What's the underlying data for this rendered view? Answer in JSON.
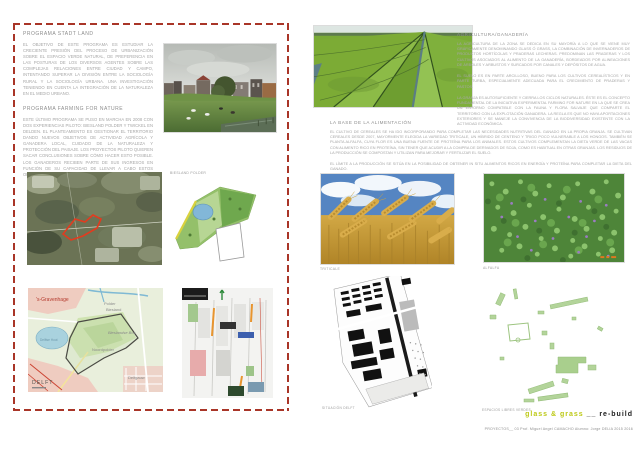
{
  "board": {
    "left": {
      "sections": [
        {
          "heading": "PROGRAMA STADT LAND",
          "body": "EL OBJETIVO DE ESTE PROGRAMA ES ESTUDIAR LA CRECIENTE PRESIÓN DEL PROCESO DE URBANIZACIÓN SOBRE EL ESPACIO VERDE NATURAL, DE PREFERENCIA EN LAS POSTURAS DE LOS DIVERSOS AGENTES SOBRE LAS COMPLEJAS RELACIONES ENTRE CIUDAD Y CAMPO, INTENTANDO SUPERAR LA DIVISIÓN ENTRE LA SOCIOLOGÍA RURAL Y LA SOCIOLOGÍA URBANA. UNA INVESTIGACIÓN TENIENDO EN CUENTA LA INTEGRACIÓN DE LA NATURALEZA EN EL MEDIO URBANO."
        },
        {
          "heading": "PROGRAMA FARMING FOR NATURE",
          "body": "ESTE ÚLTIMO PROGRAMA SE PUSO EN MARCHA EN 2008 CON DOS EXPERIENCIAS PILOTO: BIESLAND POLDER Y TWICKEL EN DELDEN. EL PLANTEAMIENTO ES GESTIONAR EL TERRITORIO DANDO NUEVOS OBJETIVOS DE ACTIVIDAD AGRÍCOLA Y GANADERA LOCAL, CUIDADO DE LA NATURALEZA Y PROTECCIÓN DEL PAISAJE. LOS PROYECTOS PILOTO QUIEREN SACAR CONCLUSIONES SOBRE CÓMO HACER ESTO POSIBLE. LOS GANADEROS RECIBEN PARTE DE SUS INGRESOS EN FUNCIÓN DE SU CAPACIDAD DE LLEVAR A CABO ESTOS OBJETIVOS AMBIENTALES Y TERRITORIALES."
        }
      ],
      "biesland_plan_label": "BIESLAND POLDER",
      "street_map": {
        "city": "'s-Gravenhage",
        "polder_line1": "Polder",
        "polder_line2": "Biesland",
        "bos": "Bieslandse Bos",
        "noordpolder": "Noordpolder",
        "delft": "DELFT",
        "delfgauw": "Delfgauw",
        "delftse_hout": "Delftse Hout"
      }
    },
    "right": {
      "sections": [
        {
          "heading": "AGRICULTURA/GANADERÍA",
          "paragraphs": [
            "LA AGRICULTURA DE LA ZONA SE DEDICA EN SU MAYORÍA A LO QUE SE VIENE MUY GRÁFICAMENTE DENOMINANDO GLASS Ó GRASS, LA COMBINACIÓN DE INVERNADEROS DE PRODUCTOS HORTÍCOLAS Y PRADERAS LECHERAS. PREDOMINAN LAS PRADERAS Y LOS CULTIVOS ASOCIADOS AL ALIMENTO DE LA GANADERÍA, BORDEADOS POR ALINEACIONES DE ÁRBOLES Y ARBUSTOS Y SURCADOS POR CANALES Y DEPÓSITOS DE AGUA.",
            "EL SUELO ES EN PARTE ARCILLOSO, BUENO PARA LOS CULTIVOS CEREALÍSTICOS Y EN PARTE TURBA, ESPECIALMENTE ADECUADA PARA EL CRECIMIENTO DE PRADERAS Y PASTOS.",
            "LA GRANJA ES AUTOSUFICIENTE Y CIERRA LOS CICLOS NATURALES. ÉSTE ES EL CONCEPTO FUNDAMENTAL DE LA INICIATIVA EXPERIMENTAL FARMING FOR NATURE EN LA QUE SE CREA UN ENTORNO COMPATIBLE CON LA FAUNA Y FLORA SALVAJE QUE COMPARTE EL TERRITORIO CON LA EXPLOTACIÓN GANADERA. LA REGLA ES QUE NO HAYA APORTACIONES EXTERIORES Y SE MANEJE LA CONVIVENCIA DE LA BIODIVERSIDAD EXISTENTE CON LA ACTIVIDAD ECONÓMICA."
          ]
        },
        {
          "heading": "LA BASE DE LA ALIMENTACIÓN",
          "paragraphs": [
            "EL CULTIVO DE CEREALES SE HA IDO INCORPORANDO PARA COMPLETAR LAS NECESIDADES NUTRITIVAS DEL GANADO EN LA PROPIA GRANJA. SE CULTIVAN CEREALES DESDE 2007, MAYORMENTE ELEGIDA LA VARIEDAD TRITICALE, UN HÍBRIDO DE CENTENO Y TRIGO POCO VULNERABLE A LOS HONGOS. TAMBIÉN SE PLANTA ALFALFA, CUYA FLOR ES UNA BUENA FUENTE DE PROTEÍNA PARA LOS ANIMALES. ESTOS CULTIVOS COMPLEMENTAN LA DIETA VERDE DE LAS VACAS CON ALIMENTO RICO EN PROTEÍNA, SIN TENER QUE ACUDIR A LA COMPRA DE DERIVADOS DE SOJA, COMO ES HABITUAL EN OTRAS GRANJAS. LOS RESIDUOS DE LA PRODUCCIÓN SE COMPOSTAN Y UTILIZAN PARA MEJORAR Y FERTILIZAR EL SUELO.",
            "EL LÍMITE A LA PRODUCCIÓN SE SITÚA EN LA POSIBILIDAD DE OBTENER IN SITU ALIMENTOS RICOS EN ENERGÍA Y PROTEÍNA PARA COMPLETAR LA DIETA DEL GANADO."
          ]
        }
      ],
      "captions": {
        "triticale": "TRITICALE",
        "alfalfa": "ALFALFA",
        "situacion_delft": "SITUACIÓN DELFT",
        "espacios_libres": "ESPACIOS LIBRES VERDES"
      },
      "title": {
        "primary": "glass & grass",
        "separator": "__",
        "secondary": "re-build"
      },
      "credits": "PROYECTOS__ 03   Prof. Miguel Angel CAMACHO    Alumno: Jorge DELIA    2015 2016"
    },
    "colors": {
      "accent_red": "#a93528",
      "title_yellow": "#bdc916",
      "text_gray": "#9a9a9a"
    }
  }
}
